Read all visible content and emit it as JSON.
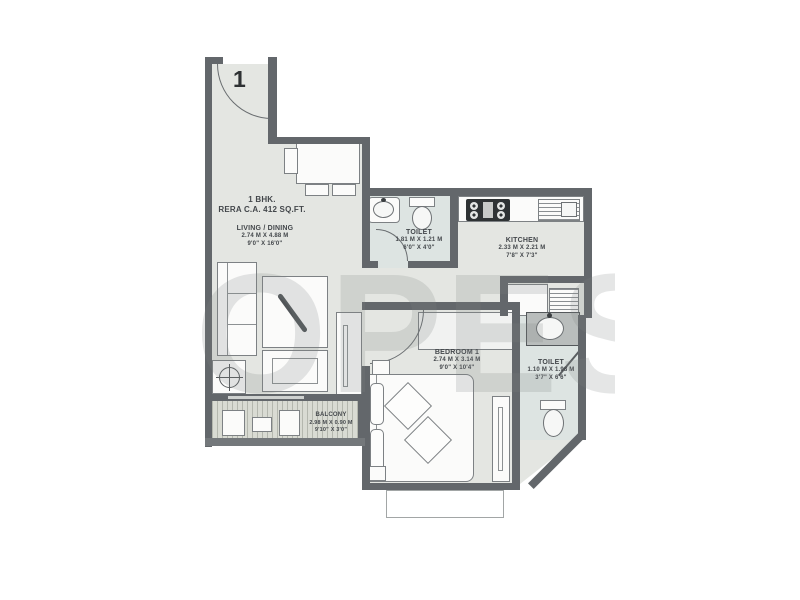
{
  "plan": {
    "title_line1": "1 BHK.",
    "title_line2": "RERA C.A. 412 SQ.FT.",
    "entrance_door_label": "1",
    "watermark_text": "OPES",
    "rooms": [
      {
        "id": "living",
        "name": "LIVING / DINING",
        "dim_m": "2.74 M X 4.88 M",
        "dim_ft": "9'0\" X 16'0\""
      },
      {
        "id": "toilet1",
        "name": "TOILET",
        "dim_m": "1.81 M X 1.21 M",
        "dim_ft": "6'0\" X 4'0\""
      },
      {
        "id": "kitchen",
        "name": "KITCHEN",
        "dim_m": "2.33 M X 2.21 M",
        "dim_ft": "7'8\" X 7'3\""
      },
      {
        "id": "bedroom",
        "name": "BEDROOM 1",
        "dim_m": "2.74 M X 3.14 M",
        "dim_ft": "9'0\" X 10'4\""
      },
      {
        "id": "toilet2",
        "name": "TOILET",
        "dim_m": "1.10 M X 1.98 M",
        "dim_ft": "3'7\" X 6'6\""
      },
      {
        "id": "balcony",
        "name": "BALCONY",
        "dim_m": "2.98 M X 0.90 M",
        "dim_ft": "9'10\" X 3'0\""
      }
    ],
    "fixtures": [
      "entrance-door",
      "dining-table",
      "dining-chairs",
      "sofa",
      "coffee-table",
      "armchair",
      "side-table",
      "tv-unit",
      "washbasin",
      "wc",
      "kitchen-hob",
      "kitchen-sink",
      "kitchen-platform",
      "utility-sink",
      "wardrobe",
      "bed",
      "pillows",
      "cushions",
      "nightstands",
      "dresser",
      "balcony-seating"
    ],
    "colors": {
      "wall": "#63676b",
      "floor": "#e4e6e2",
      "toilet_floor": "#dde4e2",
      "deck": "#d9dbd3",
      "label_text": "#43474b",
      "watermark": "rgba(125,129,129,0.20)"
    }
  }
}
